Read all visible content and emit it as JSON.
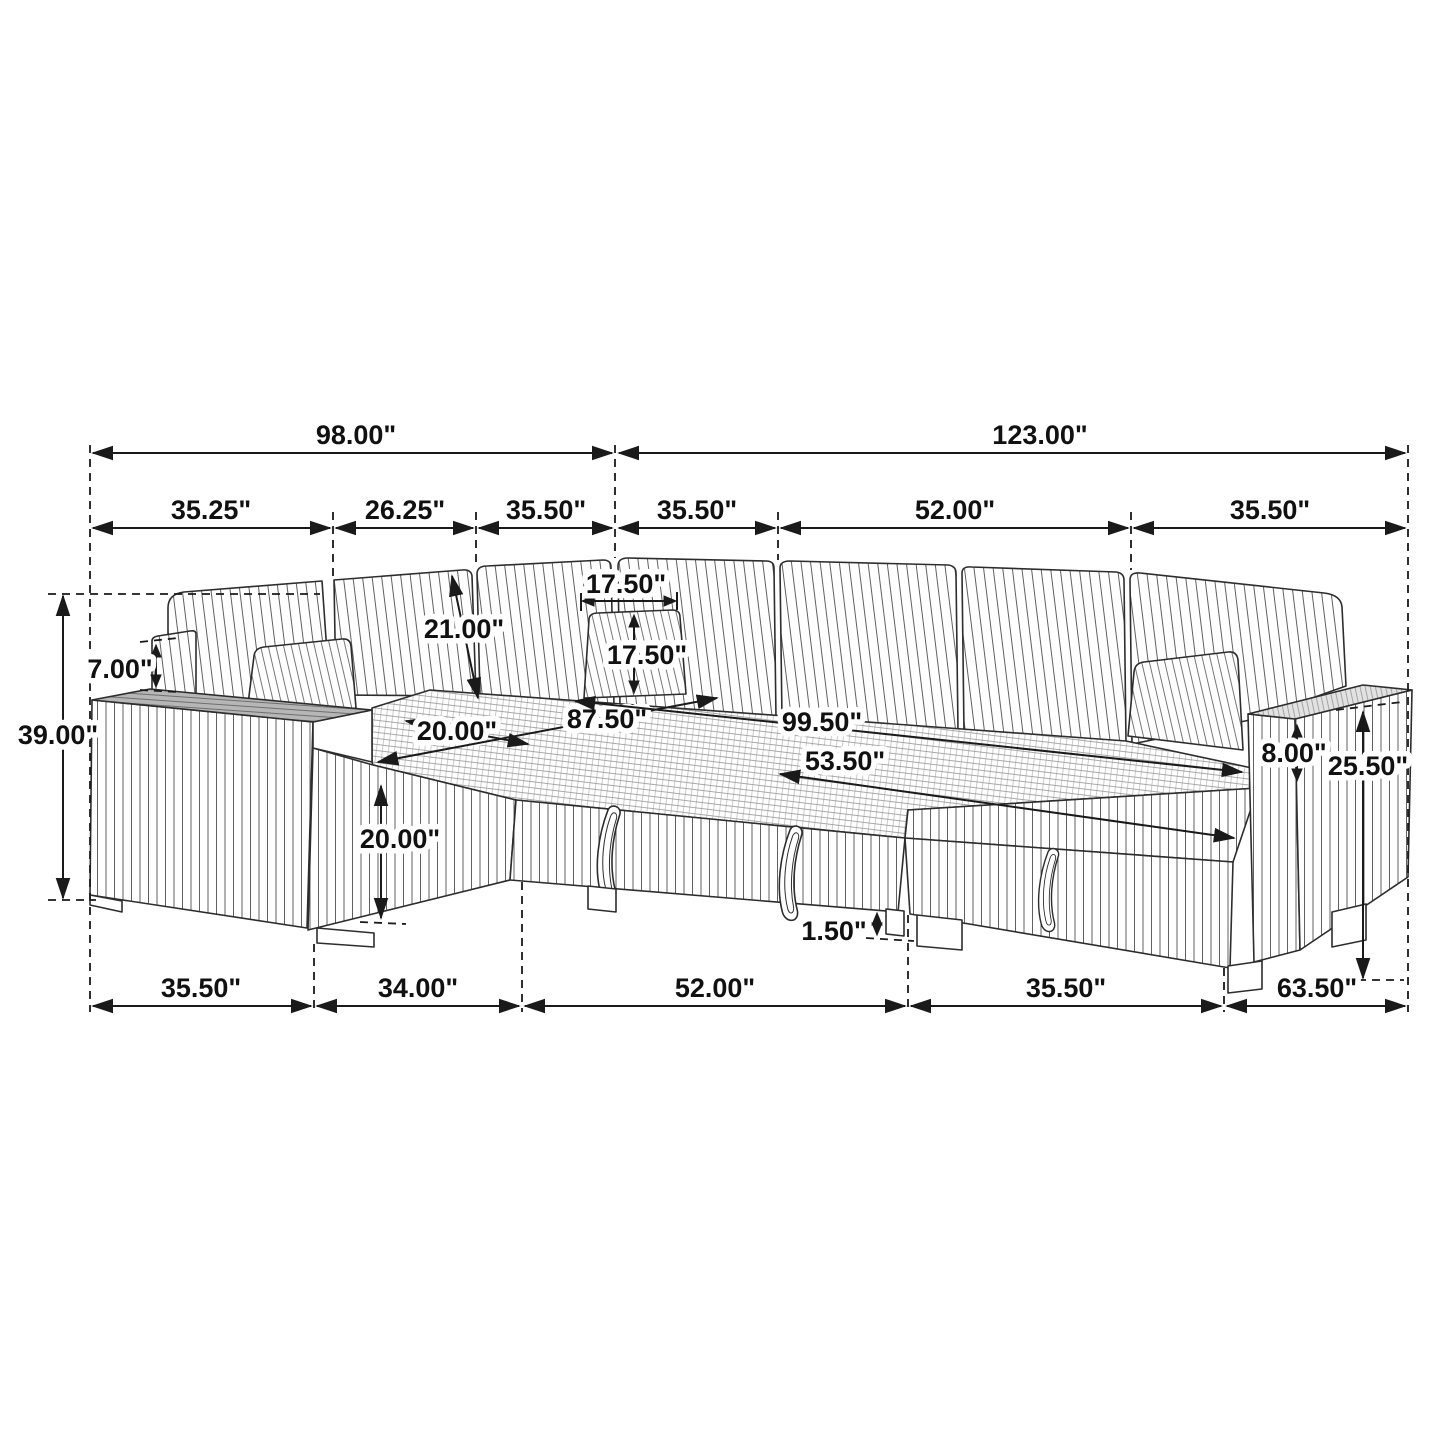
{
  "diagram": {
    "dims": {
      "top": [
        {
          "id": "overall-depth",
          "label": "98.00\""
        },
        {
          "id": "overall-width",
          "label": "123.00\""
        }
      ],
      "upper": [
        {
          "id": "depth-seg-1",
          "label": "35.25\""
        },
        {
          "id": "depth-seg-2",
          "label": "26.25\""
        },
        {
          "id": "depth-seg-3",
          "label": "35.50\""
        },
        {
          "id": "width-seg-1",
          "label": "35.50\""
        },
        {
          "id": "width-seg-2",
          "label": "52.00\""
        },
        {
          "id": "width-seg-3",
          "label": "35.50\""
        }
      ],
      "left": [
        {
          "id": "overall-height",
          "label": "39.00\""
        },
        {
          "id": "back-panel-height",
          "label": "7.00\""
        }
      ],
      "middle": [
        {
          "id": "backrest-length",
          "label": "21.00\""
        },
        {
          "id": "pillow-width",
          "label": "17.50\""
        },
        {
          "id": "pillow-height",
          "label": "17.50\""
        },
        {
          "id": "seat-depth",
          "label": "20.00\""
        },
        {
          "id": "seat-span-left",
          "label": "87.50\""
        },
        {
          "id": "seat-span-back",
          "label": "99.50\""
        },
        {
          "id": "bed-span",
          "label": "53.50\""
        },
        {
          "id": "seat-height",
          "label": "20.00\""
        }
      ],
      "right": [
        {
          "id": "arm-above-seat",
          "label": "8.00\""
        },
        {
          "id": "arm-total-height",
          "label": "25.50\""
        }
      ],
      "bottom": [
        {
          "id": "front-seg-1",
          "label": "35.50\""
        },
        {
          "id": "front-seg-2",
          "label": "34.00\""
        },
        {
          "id": "front-seg-3",
          "label": "52.00\""
        },
        {
          "id": "front-seg-4",
          "label": "35.50\""
        },
        {
          "id": "front-seg-5",
          "label": "63.50\""
        },
        {
          "id": "leg-height",
          "label": "1.50\""
        }
      ]
    }
  }
}
